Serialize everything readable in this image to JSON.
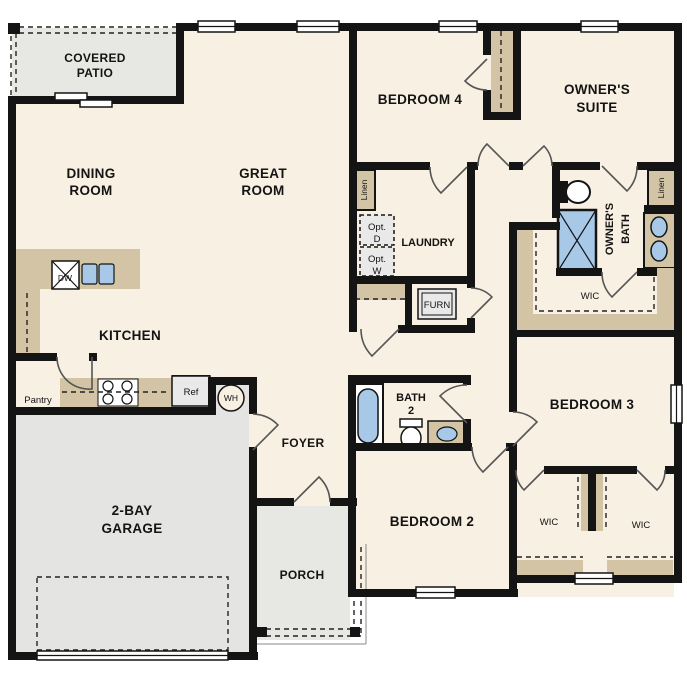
{
  "title": "Single-story floor plan",
  "labels": {
    "covered_patio_1": "COVERED",
    "covered_patio_2": "PATIO",
    "dining_1": "DINING",
    "dining_2": "ROOM",
    "great_1": "GREAT",
    "great_2": "ROOM",
    "bedroom4": "BEDROOM 4",
    "owners_suite_1": "OWNER'S",
    "owners_suite_2": "SUITE",
    "linen_hall": "Linen",
    "linen_bath": "Linen",
    "opt_d_1": "Opt.",
    "opt_d_2": "D",
    "opt_w_1": "Opt.",
    "opt_w_2": "W",
    "laundry": "LAUNDRY",
    "furnace": "FURN",
    "owners_bath_1": "OWNER'S",
    "owners_bath_2": "BATH",
    "wic_owner": "WIC",
    "wic_bed2": "WIC",
    "wic_bed3": "WIC",
    "kitchen": "KITCHEN",
    "pantry": "Pantry",
    "dishwasher": "DW",
    "refrigerator": "Ref",
    "water_heater": "WH",
    "garage_1": "2-BAY",
    "garage_2": "GARAGE",
    "foyer": "FOYER",
    "porch": "PORCH",
    "bath2_1": "BATH",
    "bath2_2": "2",
    "bedroom2": "BEDROOM 2",
    "bedroom3": "BEDROOM 3"
  },
  "colors": {
    "floor": "#f8f0e2",
    "outdoor": "#e7e7e4",
    "garage": "#e4e4e2",
    "counter": "#d2c4a4",
    "fixture_blue": "#a8c8e8",
    "wall": "#141414",
    "appliance": "#e9e9e9"
  }
}
